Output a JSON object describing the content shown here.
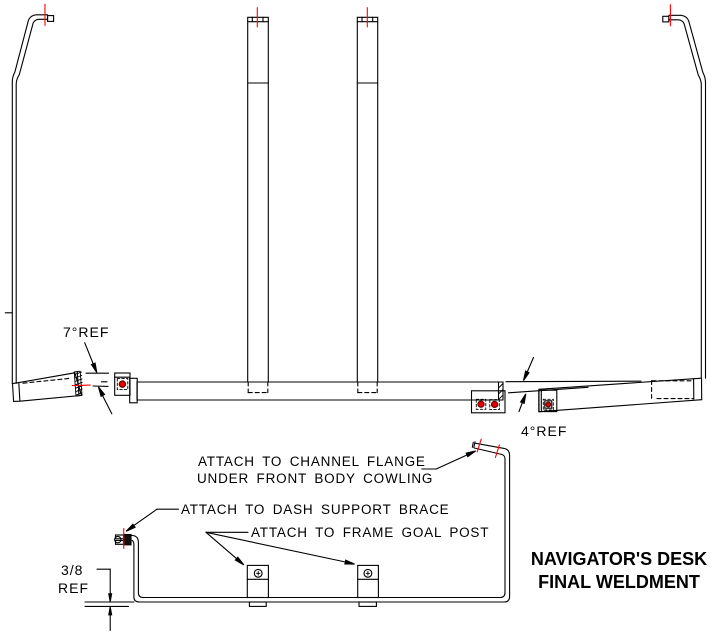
{
  "drawing": {
    "title": {
      "line1": "NAVIGATOR'S DESK",
      "line2": "FINAL WELDMENT"
    },
    "annotations": {
      "angle_left": "7°REF",
      "angle_right": "4°REF",
      "dim_fraction": "3/8",
      "dim_ref": "REF",
      "note_channel_line1": "ATTACH TO CHANNEL FLANGE",
      "note_channel_line2": "UNDER FRONT BODY COWLING",
      "note_dash_brace": "ATTACH TO DASH SUPPORT BRACE",
      "note_goal_post": "ATTACH TO FRAME GOAL POST"
    },
    "colors": {
      "line": "#000000",
      "centerline": "#ff0000",
      "hole_fill": "#e80000"
    }
  }
}
